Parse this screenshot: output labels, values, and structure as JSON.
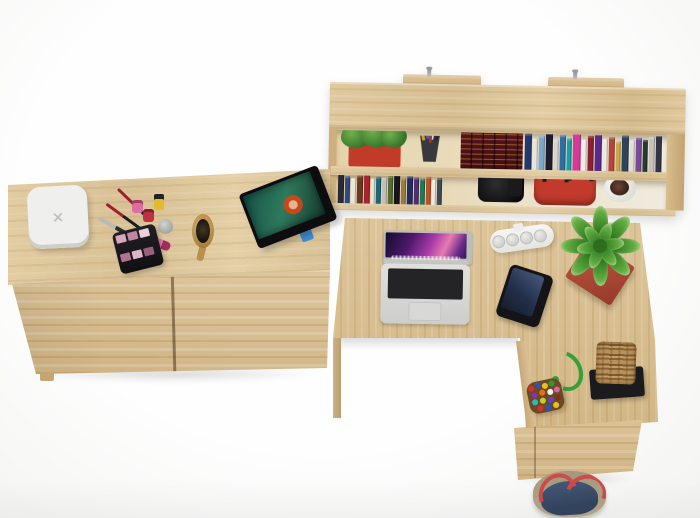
{
  "scene": {
    "description": "Top view 3D render of an oak home office set: wall shelf with books, low dresser with cosmetics and tablet, and L-shaped corner desk with laptop",
    "background": "#fbfbfa",
    "wood_color": "#dcc498",
    "charger_mark": "×"
  },
  "shelf": {
    "planter": {
      "box": "#c23a28",
      "plant": "#4e8f35"
    },
    "pen_cup": "#38383f",
    "pens": [
      "#d0a030",
      "#3a6ac0",
      "#d8d8d8",
      "#282828",
      "#b03030"
    ],
    "encyclopedia": {
      "cover": "#4d1119",
      "gilding": "#d0a03e"
    },
    "upper_books": [
      {
        "c": "#23386e",
        "h": 36,
        "w": 7
      },
      {
        "c": "#e8e5de",
        "h": 31,
        "w": 5
      },
      {
        "c": "#7aa8c8",
        "h": 34,
        "w": 6
      },
      {
        "c": "#1c1c2a",
        "h": 37,
        "w": 7
      },
      {
        "c": "#d8d4cb",
        "h": 30,
        "w": 5
      },
      {
        "c": "#2e6e9e",
        "h": 35,
        "w": 6
      },
      {
        "c": "#18a0a8",
        "h": 32,
        "w": 5
      },
      {
        "c": "#d43a9a",
        "h": 38,
        "w": 8
      },
      {
        "c": "#f0ede6",
        "h": 31,
        "w": 5
      },
      {
        "c": "#8a2030",
        "h": 35,
        "w": 6
      },
      {
        "c": "#5a2a8a",
        "h": 37,
        "w": 7
      },
      {
        "c": "#efe9df",
        "h": 32,
        "w": 5
      },
      {
        "c": "#b5453a",
        "h": 34,
        "w": 6
      },
      {
        "c": "#caa84a",
        "h": 30,
        "w": 5
      },
      {
        "c": "#30425a",
        "h": 36,
        "w": 7
      },
      {
        "c": "#e2ded6",
        "h": 31,
        "w": 5
      },
      {
        "c": "#7a4a9a",
        "h": 34,
        "w": 6
      },
      {
        "c": "#263a2e",
        "h": 32,
        "w": 5
      },
      {
        "c": "#c8c2b8",
        "h": 35,
        "w": 6
      },
      {
        "c": "#343444",
        "h": 37,
        "w": 6
      }
    ],
    "lower_books": [
      {
        "c": "#2a2a36",
        "h": 34,
        "w": 6
      },
      {
        "c": "#2b4a8a",
        "h": 31,
        "w": 5
      },
      {
        "c": "#eae6dd",
        "h": 29,
        "w": 5
      },
      {
        "c": "#6a3a20",
        "h": 32,
        "w": 6
      },
      {
        "c": "#a82430",
        "h": 34,
        "w": 6
      },
      {
        "c": "#e6e2d8",
        "h": 29,
        "w": 4
      },
      {
        "c": "#186878",
        "h": 31,
        "w": 5
      },
      {
        "c": "#c4c0b8",
        "h": 30,
        "w": 5
      },
      {
        "c": "#556b2f",
        "h": 32,
        "w": 5
      },
      {
        "c": "#16161e",
        "h": 34,
        "w": 6
      },
      {
        "c": "#9a7a46",
        "h": 30,
        "w": 5
      },
      {
        "c": "#1e2e5e",
        "h": 32,
        "w": 6
      },
      {
        "c": "#582a6e",
        "h": 31,
        "w": 5
      },
      {
        "c": "#1f7a52",
        "h": 30,
        "w": 5
      },
      {
        "c": "#b8532a",
        "h": 32,
        "w": 5
      },
      {
        "c": "#efe9e0",
        "h": 29,
        "w": 4
      },
      {
        "c": "#3a4a5a",
        "h": 31,
        "w": 5
      }
    ],
    "camera": "#141416",
    "handbag": {
      "body": "#c13a2c",
      "handles": "#1d1d1f"
    },
    "white_pot": {
      "pot": "#f1efe9",
      "plant": "#4a2c20"
    }
  },
  "dresser": {
    "charger_body": "#efefed",
    "makeup": {
      "brush_black": "#1c1c1e",
      "brush_red": "#9c2030",
      "brush_silver": "#b9b9b7",
      "polish_pink": "#dd6f9f",
      "polish_red": "#c03040",
      "polish_yellow": "#e2bc2e",
      "jar_silver": "#b9b9b7",
      "lipstick": "#e678aa",
      "palette_shades": [
        "#d9a6bc",
        "#c285a2",
        "#eccfdc",
        "#b3718f",
        "#e0b4c8",
        "#9a5f80"
      ]
    },
    "hairbrush": {
      "wood": "#c49a52",
      "bristles": "#241c12"
    },
    "tablet": {
      "frame": "#0d0d10",
      "screen": "#2f7a5c",
      "stand": "#3f8fd4"
    }
  },
  "desk": {
    "laptop": {
      "body": "#dededc",
      "keys": "#242426"
    },
    "power_strip": "#f4f4f2",
    "phone": {
      "body": "#141416",
      "screen": "#2e3c5c"
    },
    "succulent": {
      "planter": "#b5503c",
      "leaves": "#4c9a38"
    },
    "bead_bag": {
      "strap": "#35a038",
      "beads": [
        "#d43030",
        "#2a52c0",
        "#e8c020",
        "#2f9a35",
        "#8a30b0",
        "#e07020",
        "#f0f0f0",
        "#e060a0",
        "#30b8c0",
        "#c0d030",
        "#6040d0",
        "#803020",
        "#d43030",
        "#2a52c0",
        "#e8c020"
      ]
    },
    "basket": {
      "weave": "#a8824e",
      "base": "#1b1b1d"
    },
    "denim_bag": {
      "denim": "#3d5472",
      "trim": "#a89a82",
      "straps": "#cf4a4a"
    }
  }
}
